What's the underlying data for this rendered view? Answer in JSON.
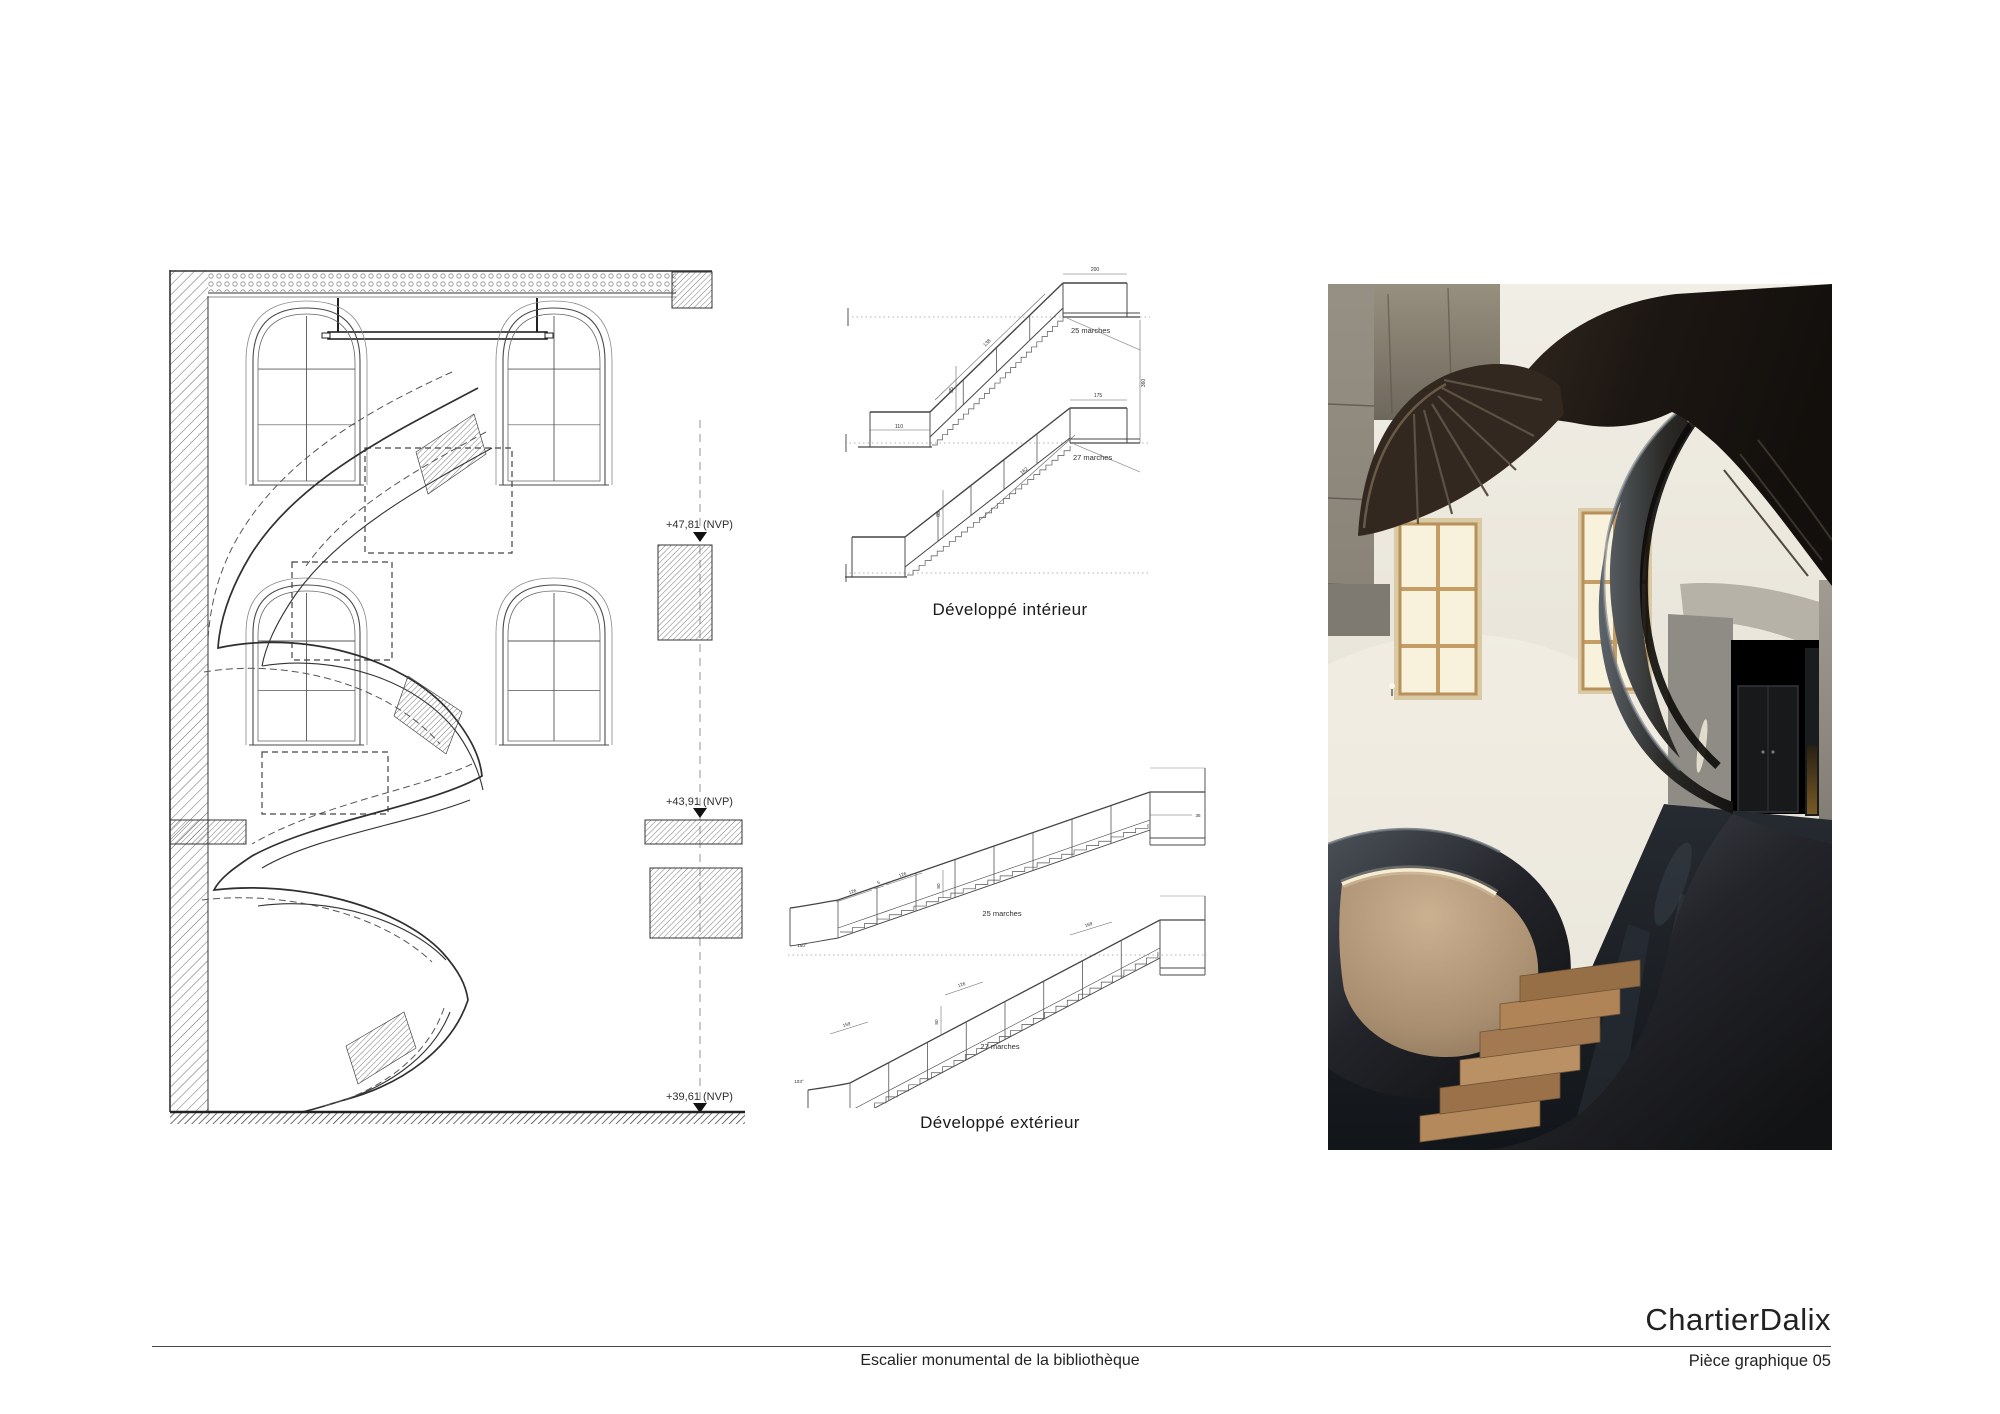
{
  "sheet": {
    "background": "#ffffff",
    "title_block": {
      "studio_name": "ChartierDalix",
      "project_title": "Escalier monumental de la bibliothèque",
      "sheet_number": "Pièce graphique 05"
    }
  },
  "section_drawing": {
    "levels": [
      {
        "label": "+47,81  (NVP)"
      },
      {
        "label": "+43,91  (NVP)"
      },
      {
        "label": "+39,61  (NVP)"
      }
    ]
  },
  "interior_elevation": {
    "caption": "Développé intérieur",
    "flights": [
      {
        "label": "25 marches",
        "steps": 25,
        "dims": [
          "110",
          "85",
          "138",
          "200",
          "360"
        ]
      },
      {
        "label": "27 marches",
        "steps": 27,
        "dims": [
          "129",
          "85",
          "162",
          "175"
        ]
      }
    ]
  },
  "exterior_elevation": {
    "caption": "Développé extérieur",
    "flights": [
      {
        "label": "25 marches",
        "steps": 25,
        "dims": [
          "126",
          "5",
          "126",
          "80",
          "150°",
          "35"
        ]
      },
      {
        "label": "27 marches",
        "steps": 27,
        "dims": [
          "159",
          "126",
          "80",
          "103°",
          "169"
        ]
      }
    ]
  },
  "photo": {
    "colors": {
      "steel_dark": "#17130f",
      "steel_sheen": "#59616a",
      "wall_cream": "#eae6db",
      "window_glow": "#f8f1dc",
      "window_frame": "#c49d64",
      "plaster_tan": "#b29878",
      "led_light": "#f6ecd2",
      "step_wood": "#ab8157",
      "floor_dark": "#181c21",
      "concrete": "#8b8478",
      "door_dark": "#17191b"
    }
  }
}
